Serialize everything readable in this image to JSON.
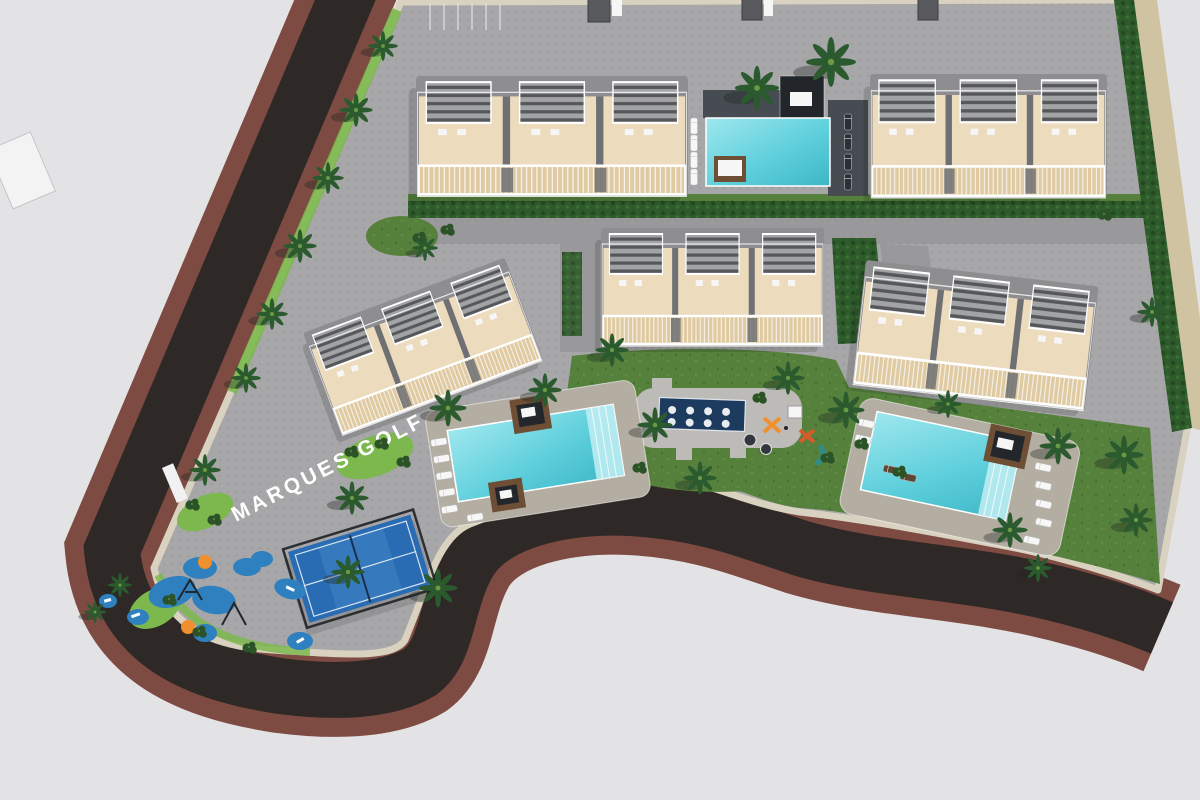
{
  "meta": {
    "title": "Aerial 3D site-plan render of the Marques Golf residential development",
    "view": "top-down masterplan perspective"
  },
  "labels": {
    "road_name": "MARQUES GOLF"
  },
  "palette": {
    "background": "#e3e3e5",
    "asphalt": "#2e2927",
    "road_stripe": "#7d4b42",
    "sidewalk": "#d9d2c0",
    "paver": "#a7a6a8",
    "paver_dark": "#929194",
    "lawn": "#55813c",
    "lawn_bright": "#7cb84e",
    "hedge": "#2e5b2b",
    "palm": "#2b5a2e",
    "wall": "#ecdbbd",
    "wall_dark": "#dfcaa2",
    "roof": "#8e8e90",
    "pergola": "#56575a",
    "pool_water": "#5fd0dc",
    "pool_water_light": "#9fe7ee",
    "deck_dark": "#474c52",
    "deck_warm": "#b4ada2",
    "spa": "#1d3a5f",
    "play_blue": "#2f80bf",
    "orange": "#ef8f2d",
    "padel": "#2a6cb3",
    "sand": "#cfc3a2",
    "brown": "#6e4f36"
  },
  "features": {
    "buildings": [
      "north-west apartment block",
      "north-east apartment block",
      "central apartment block",
      "west rotated apartment block",
      "east apartment block"
    ],
    "amenities": [
      "north deck pool",
      "west communal pool",
      "east communal pool",
      "spa water feature",
      "children playground",
      "central play area",
      "padel court"
    ],
    "landscape": [
      "palm trees",
      "hedges",
      "lawns",
      "sand path"
    ],
    "roads": [
      "perimeter road",
      "internal paved streets",
      "crosswalk"
    ]
  }
}
